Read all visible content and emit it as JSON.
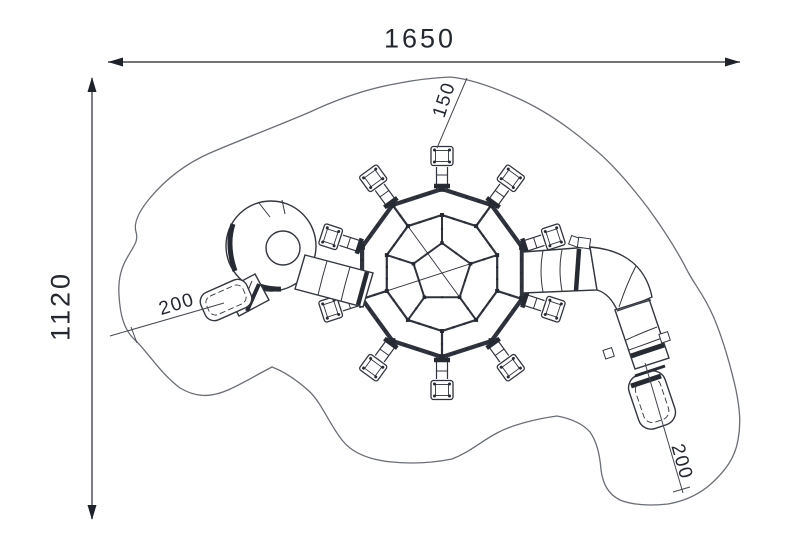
{
  "drawing": {
    "description": "Plan view technical drawing of a geodesic dome climber with two tube slides inside a safety-zone outline",
    "labels": {
      "overall_width": "1650",
      "overall_depth": "1120",
      "ladder_clearance": "150",
      "left_slide_clearance": "200",
      "right_slide_clearance": "200"
    },
    "colors": {
      "background": "#ffffff",
      "structure_line": "#2f333d",
      "structure_dark": "#262a33",
      "safety_zone_outline": "#6a6e76",
      "dimension_line": "#43474f",
      "label_text": "#232730"
    }
  }
}
